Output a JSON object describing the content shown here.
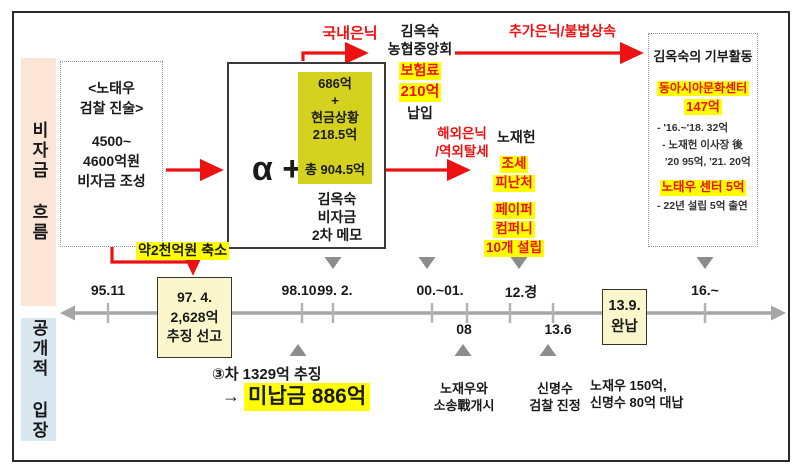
{
  "colors": {
    "accent_red": "#ee1111",
    "highlight_yellow": "#ffff00",
    "memo_olive_yellow": "#d4d21f",
    "timeline_box_cream": "#fbf6cb",
    "band_peach": "#fce4d6",
    "band_blue": "#d9e8f0",
    "timeline_gray": "#a6a6a6",
    "triangle_gray": "#8c8c8c"
  },
  "left_bands": {
    "fund_flow": "비자금 흐름",
    "public_stance": "공개적 입장"
  },
  "testimony_box": {
    "lines": [
      "<노태우",
      "검찰 진술>",
      "4500~",
      "4600억원",
      "비자금 조성"
    ]
  },
  "memo_box": {
    "alpha": "α +",
    "amount_lines": [
      "686억",
      "+",
      "현금상황",
      "218.5억"
    ],
    "total": "총 904.5억",
    "caption": [
      "김옥숙",
      "비자금",
      "2차 메모"
    ]
  },
  "flow_labels": {
    "domestic_hiding": "국내은닉",
    "additional_hiding": "추가은닉/불법상속",
    "overseas_hiding": [
      "해외은닉",
      "/역외탈세"
    ],
    "reduction": "약2천억원 축소"
  },
  "insurance": {
    "who": [
      "김옥숙",
      "농협중앙회"
    ],
    "highlights": [
      "보험료",
      "210억"
    ],
    "tail": "납입"
  },
  "overseas": {
    "person": "노재헌",
    "tax_haven": [
      "조세",
      "피난처"
    ],
    "paper_company": [
      "페이퍼",
      "컴퍼니",
      "10개 설립"
    ]
  },
  "donation_box": {
    "title": "김옥숙의 기부활동",
    "center1": "동아시아문화센터",
    "center1_amount": "147억",
    "notes": [
      "- '16.~'18. 32억",
      "- 노재헌 이사장 後",
      "'20 95억, '21. 20억"
    ],
    "center2": "노태우 센터 5억",
    "center2_note": "- 22년 설립 5억 출연"
  },
  "timeline": {
    "labels_above": [
      "95.11",
      "98.10.",
      "99. 2.",
      "00.~01.",
      "12.경",
      "16.~"
    ],
    "labels_below": [
      "08",
      "13.6"
    ],
    "box_1997": [
      "97. 4.",
      "2,628억",
      "추징 선고"
    ],
    "box_2013": [
      "13.9.",
      "완납"
    ]
  },
  "bottom": {
    "collection": "③차 1329억 추징",
    "arrow": "→",
    "unpaid": "미납금 886억",
    "lawsuit": [
      "노재우와",
      "소송戰개시"
    ],
    "petition": [
      "신명수",
      "검찰 진정"
    ],
    "payment": [
      "노재우 150억,",
      "신명수 80억 대납"
    ]
  }
}
